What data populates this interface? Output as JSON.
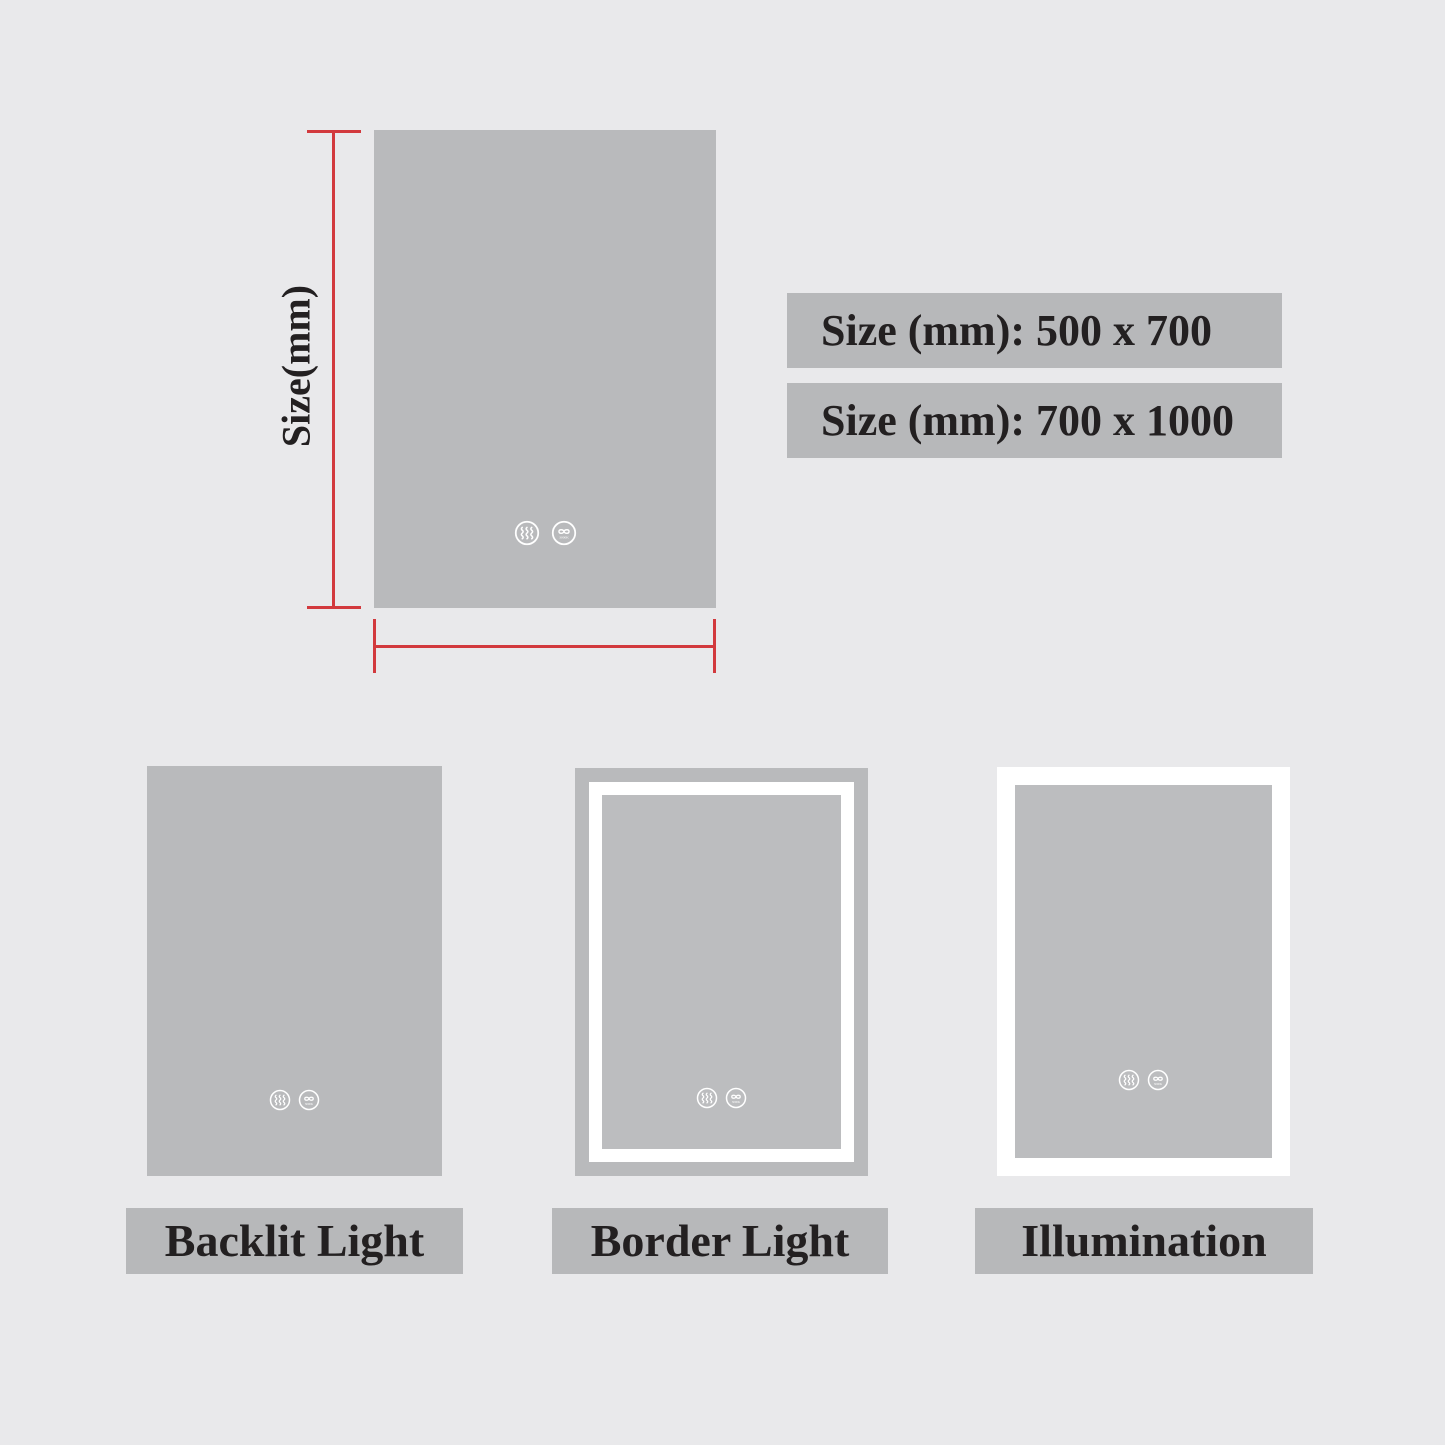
{
  "colors": {
    "background": "#e9e9eb",
    "mirror_gray": "#b9babc",
    "bar_gray": "#b7b8ba",
    "inner_gray": "#bcbdbf",
    "accent_red": "#d2393d",
    "text": "#232021",
    "led_white": "#ffffff"
  },
  "size_diagram": {
    "axis_label": "Size(mm)",
    "size_options": [
      "Size (mm): 500 x 700",
      "Size (mm): 700 x 1000"
    ]
  },
  "mirror_icons": {
    "defogger": "defogger-icon",
    "color_temperature": "color-temperature-icon",
    "color_temperature_caption": "3000K"
  },
  "variants": [
    {
      "label": "Backlit Light"
    },
    {
      "label": "Border Light"
    },
    {
      "label": "Illumination"
    }
  ]
}
